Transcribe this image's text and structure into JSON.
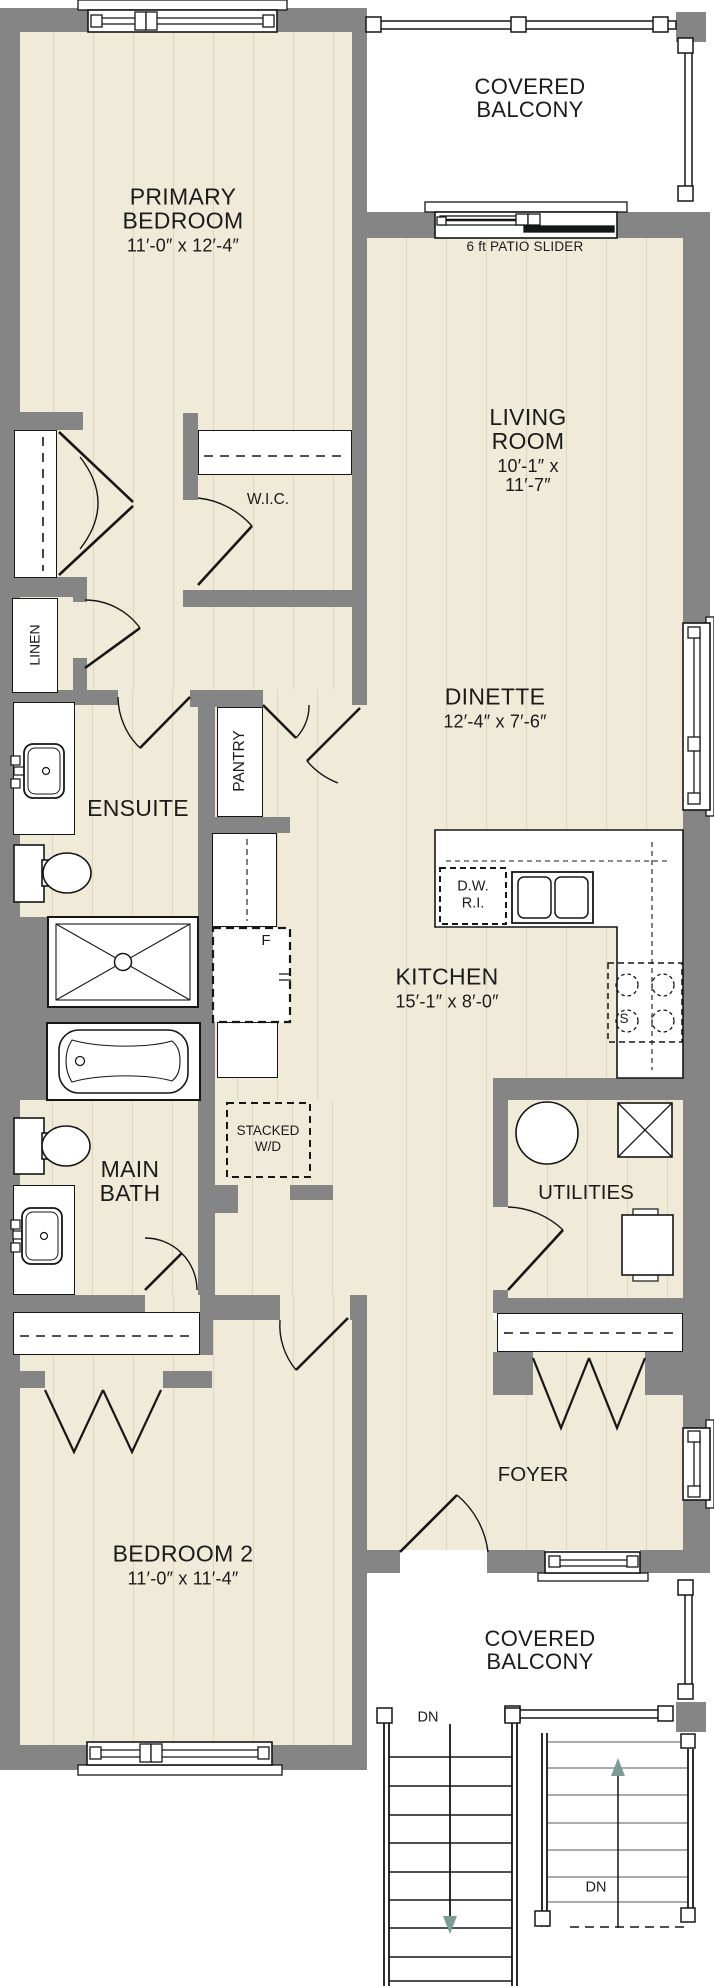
{
  "plan": {
    "rooms": {
      "primary_bedroom": {
        "label": "PRIMARY BEDROOM",
        "dims": "11′-0″ x 12′-4″"
      },
      "living_room": {
        "label": "LIVING ROOM",
        "dims": "10′-1″ x 11′-7″"
      },
      "dinette": {
        "label": "DINETTE",
        "dims": "12′-4″ x 7′-6″"
      },
      "kitchen": {
        "label": "KITCHEN",
        "dims": "15′-1″ x 8′-0″"
      },
      "bedroom2": {
        "label": "BEDROOM 2",
        "dims": "11′-0″ x 11′-4″"
      },
      "ensuite": {
        "label": "ENSUITE"
      },
      "main_bath": {
        "label": "MAIN BATH"
      },
      "foyer": {
        "label": "FOYER"
      },
      "utilities": {
        "label": "UTILITIES"
      },
      "wic": {
        "label": "W.I.C."
      },
      "pantry": {
        "label": "PANTRY"
      },
      "linen": {
        "label": "LINEN"
      },
      "balcony_top": {
        "label": "COVERED BALCONY"
      },
      "balcony_bottom": {
        "label": "COVERED BALCONY"
      }
    },
    "annotations": {
      "patio_slider": "6 ft PATIO SLIDER",
      "dw_ri": "D.W. R.I.",
      "stacked_wd": "STACKED W/D",
      "fridge": "F",
      "stove": "S",
      "stairs_left_dn": "DN",
      "stairs_right_dn": "DN"
    },
    "colors": {
      "floor": "#f0ead9",
      "plank_line": "#ded5c0",
      "wall": "#858585",
      "line": "#161616",
      "stair_arrow": "#7d9b95"
    }
  }
}
